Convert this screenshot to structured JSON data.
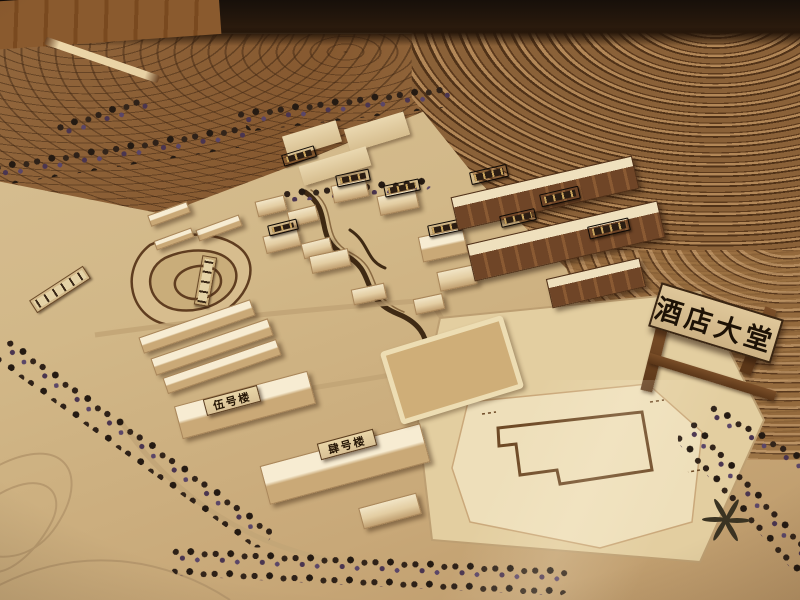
{
  "scene": {
    "subject": "Photograph of a laser-cut wooden architectural scale model of a hillside resort masterplan, viewed obliquely under warm indoor light",
    "setting": "Model sits on a table; dark room background and a strip of wooden floor are visible along the top edge",
    "features": "Terraced contour hillsides, rows of dark model trees, clusters of light plywood buildings, red-brown townhouse rows, a winding engraved stream, a contoured lake, a stippled water-feature garden, a large flat plaza with an engraved courtyard-building footprint, and a wooden gate trestle carrying the hotel-lobby sign"
  },
  "labels": {
    "gate_sign": "酒店大堂",
    "building_no5": "伍号楼",
    "building_no4": "肆号楼"
  },
  "palette": {
    "room_dark": "#120b07",
    "floor_wood": "#8a5a2e",
    "hill_wood": "#8a6138",
    "contour_line": "#503218",
    "sand_base": "#d2b888",
    "plaza": "#e3cea0",
    "plywood_board": "#eedfba",
    "building_light": "#f2e5c6",
    "townhouse_brown": "#6f4527",
    "tree_dark": "#2e2118",
    "tree_purple": "#5a4668",
    "plaque_dark": "#2b1d12",
    "plaque_gold": "#c9a35c",
    "sign_wood": "#d9c195",
    "ink": "#241505"
  }
}
